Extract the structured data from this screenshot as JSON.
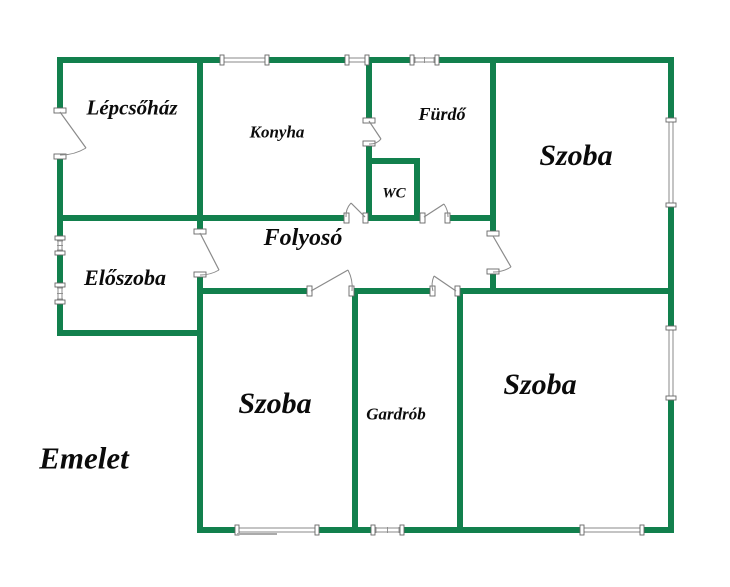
{
  "canvas": {
    "width": 730,
    "height": 587
  },
  "colors": {
    "background": "#FFFFFF",
    "wall": "#12804D",
    "label_text": "#0B0B0B",
    "fixture": "#8A8A8A",
    "fixture_dark": "#666666",
    "sill": "#AAAAAA"
  },
  "floor_label": {
    "text": "Emelet",
    "cx": 84,
    "cy": 458,
    "size": 31
  },
  "rooms": [
    {
      "key": "lepcsohaz",
      "label": "Lépcsőház",
      "cx": 132,
      "cy": 108,
      "size": 21
    },
    {
      "key": "konyha",
      "label": "Konyha",
      "cx": 277,
      "cy": 132,
      "size": 17
    },
    {
      "key": "furdo",
      "label": "Fürdő",
      "cx": 442,
      "cy": 114,
      "size": 18
    },
    {
      "key": "wc",
      "label": "WC",
      "cx": 394,
      "cy": 194,
      "size": 15
    },
    {
      "key": "szoba-felso",
      "label": "Szoba",
      "cx": 576,
      "cy": 156,
      "size": 30
    },
    {
      "key": "folyoso",
      "label": "Folyosó",
      "cx": 303,
      "cy": 238,
      "size": 24
    },
    {
      "key": "eloszoba",
      "label": "Előszoba",
      "cx": 125,
      "cy": 278,
      "size": 22
    },
    {
      "key": "szoba-also-bal",
      "label": "Szoba",
      "cx": 275,
      "cy": 404,
      "size": 30
    },
    {
      "key": "gardrob",
      "label": "Gardrób",
      "cx": 396,
      "cy": 414,
      "size": 17
    },
    {
      "key": "szoba-also-jobb",
      "label": "Szoba",
      "cx": 540,
      "cy": 385,
      "size": 30
    }
  ],
  "structure": {
    "walls": [
      [
        57,
        57,
        165,
        6
      ],
      [
        267,
        57,
        80,
        6
      ],
      [
        367,
        57,
        45,
        6
      ],
      [
        437,
        57,
        237,
        6
      ],
      [
        57,
        57,
        6,
        53
      ],
      [
        57,
        157,
        6,
        81
      ],
      [
        57,
        253,
        6,
        32
      ],
      [
        57,
        302,
        6,
        34
      ],
      [
        668,
        57,
        6,
        63
      ],
      [
        668,
        205,
        6,
        123
      ],
      [
        668,
        398,
        6,
        135
      ],
      [
        197,
        527,
        40,
        6
      ],
      [
        317,
        527,
        56,
        6
      ],
      [
        402,
        527,
        180,
        6
      ],
      [
        642,
        527,
        32,
        6
      ],
      [
        57,
        215,
        289,
        6
      ],
      [
        366,
        215,
        56,
        6
      ],
      [
        448,
        215,
        48,
        6
      ],
      [
        57,
        330,
        146,
        6
      ],
      [
        197,
        288,
        112,
        6
      ],
      [
        352,
        288,
        80,
        6
      ],
      [
        458,
        288,
        216,
        6
      ],
      [
        197,
        57,
        6,
        158
      ],
      [
        197,
        221,
        6,
        10
      ],
      [
        197,
        275,
        6,
        258
      ],
      [
        366,
        57,
        6,
        63
      ],
      [
        366,
        144,
        6,
        77
      ],
      [
        366,
        158,
        54,
        6
      ],
      [
        414,
        158,
        6,
        63
      ],
      [
        490,
        57,
        6,
        176
      ],
      [
        490,
        272,
        6,
        22
      ],
      [
        352,
        288,
        6,
        245
      ],
      [
        457,
        288,
        6,
        245
      ]
    ],
    "windows": [
      {
        "rect": [
          222,
          57,
          45,
          6
        ],
        "style": "plain"
      },
      {
        "rect": [
          347,
          57,
          20,
          6
        ],
        "style": "plain"
      },
      {
        "rect": [
          412,
          57,
          25,
          6
        ],
        "style": "hatched"
      },
      {
        "rect": [
          668,
          120,
          6,
          85
        ],
        "style": "plain"
      },
      {
        "rect": [
          668,
          328,
          6,
          70
        ],
        "style": "plain"
      },
      {
        "rect": [
          57,
          238,
          6,
          15
        ],
        "style": "hatched"
      },
      {
        "rect": [
          57,
          285,
          6,
          17
        ],
        "style": "hatched"
      },
      {
        "rect": [
          237,
          527,
          80,
          6
        ],
        "style": "plain"
      },
      {
        "rect": [
          373,
          527,
          29,
          6
        ],
        "style": "hatched"
      },
      {
        "rect": [
          582,
          527,
          60,
          6
        ],
        "style": "plain"
      }
    ],
    "doors": [
      {
        "name": "lepcsohaz-entry",
        "gap": [
          55,
          110,
          10,
          47
        ],
        "leaf": [
          60,
          112,
          86,
          148
        ],
        "arc": "M 60 155 Q 73.8 155.3 86 148"
      },
      {
        "name": "eloszoba-folyoso",
        "gap": [
          195,
          231,
          10,
          44
        ],
        "leaf": [
          200,
          233,
          219,
          270
        ],
        "arc": "M 200 275 Q 210.3 275.1 219 270"
      },
      {
        "name": "konyha-folyoso",
        "gap": [
          346,
          214,
          20,
          8
        ],
        "leaf": [
          365,
          217,
          351,
          203
        ],
        "arc": "M 346 217 Q 345.5 209 351 203"
      },
      {
        "name": "furdo-folyoso",
        "gap": [
          422,
          214,
          26,
          8
        ],
        "leaf": [
          424,
          217,
          444,
          204
        ],
        "arc": "M 448 217 Q 448.2 210.3 444 204"
      },
      {
        "name": "szoba-felso-folyoso",
        "gap": [
          488,
          233,
          10,
          39
        ],
        "leaf": [
          493,
          236,
          511,
          267
        ],
        "arc": "M 493 272 Q 502.6 272.1 511 267"
      },
      {
        "name": "szoba-also-bal-folyoso",
        "gap": [
          309,
          287,
          43,
          8
        ],
        "leaf": [
          311,
          291,
          348,
          270
        ],
        "arc": "M 352 291 Q 353.2 280.1 348 270"
      },
      {
        "name": "gardrob-folyoso",
        "gap": [
          432,
          287,
          26,
          8
        ],
        "leaf": [
          456,
          291,
          434,
          276
        ],
        "arc": "M 433 291 Q 430.7 283.7 434 276"
      },
      {
        "name": "konyha-furdo",
        "gap": [
          364,
          120,
          10,
          24
        ],
        "leaf": [
          369,
          121,
          381,
          139
        ],
        "arc": "M 369 144 Q 376.2 144.5 381 139"
      }
    ],
    "sill_lines": [
      [
        237,
        534,
        277,
        534
      ]
    ]
  }
}
